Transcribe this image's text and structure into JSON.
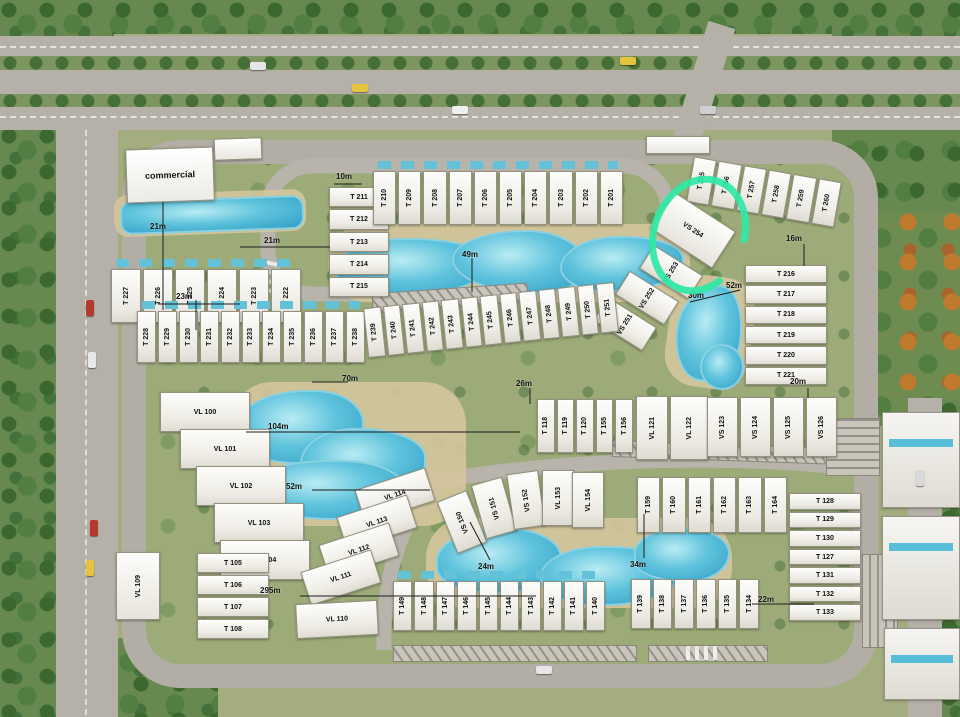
{
  "map": {
    "commercial_label": "commercial",
    "highlight": {
      "unit": "VS 254",
      "color": "#2fe8a5"
    },
    "colors": {
      "road": "#b5b1a8",
      "water": "#4fb6d6",
      "trees": "#4c7a3d",
      "annotation": "#2fe8a5"
    },
    "clusters": {
      "row_a": [
        "T 227",
        "T 226",
        "T 225",
        "T 224",
        "T 223",
        "T 222"
      ],
      "col_b": [
        "T 211",
        "T 212",
        "T 213",
        "T 214",
        "T 215"
      ],
      "row_c": [
        "T 210",
        "T 209",
        "T 208",
        "T 207",
        "T 206",
        "T 205",
        "T 204",
        "T 203",
        "T 202",
        "T 201"
      ],
      "row_d": [
        "T 255",
        "T 256",
        "T 257",
        "T 258",
        "T 259",
        "T 260"
      ],
      "col_e": [
        "T 216",
        "T 217",
        "T 218",
        "T 219",
        "T 220",
        "T 221"
      ],
      "vs_diag": [
        "VS 251",
        "VS 252",
        "VS 253"
      ],
      "vs_circled": "VS 254",
      "row_g": [
        "T 228",
        "T 229",
        "T 230",
        "T 231",
        "T 232",
        "T 233",
        "T 234",
        "T 235",
        "T 236",
        "T 237",
        "T 238"
      ],
      "row_h": [
        "T 239",
        "T 240",
        "T 241",
        "T 242",
        "T 243",
        "T 244",
        "T 245",
        "T 246",
        "T 247",
        "T 248",
        "T 249",
        "T 250",
        "T 251"
      ],
      "col_vl1": [
        "VL 100",
        "VL 101",
        "VL 102",
        "VL 103",
        "VL 104"
      ],
      "col_t105": [
        "T 105",
        "T 106",
        "T 107",
        "T 108"
      ],
      "vl_109": "VL 109",
      "col_vl2": [
        "VL 114",
        "VL 113",
        "VL 112",
        "VL 111",
        "VL 110"
      ],
      "row_m": [
        "T 118",
        "T 119",
        "T 120",
        "T 155",
        "T 156"
      ],
      "vl_pair": [
        "VL 121",
        "VL 122"
      ],
      "vs_row": [
        "VS 123",
        "VS 124",
        "VS 125",
        "VS 126"
      ],
      "vs_mid": [
        "VS 150",
        "VS 151",
        "VS 152",
        "VL 153",
        "VL 154"
      ],
      "row_q": [
        "T 159",
        "T 160",
        "T 161",
        "T 162",
        "T 163",
        "T 164"
      ],
      "row_r": [
        "T 149",
        "T 148",
        "T 147",
        "T 146",
        "T 145",
        "T 144",
        "T 143",
        "T 142",
        "T 141",
        "T 140"
      ],
      "row_s": [
        "T 139",
        "T 138",
        "T 137",
        "T 136",
        "T 135",
        "T 134"
      ],
      "col_t": [
        "T 128",
        "T 129",
        "T 130",
        "T 127",
        "T 131",
        "T 132",
        "T 133"
      ]
    },
    "distances": {
      "d0": "21m",
      "d1": "21m",
      "d2": "23m",
      "d3": "10m",
      "d4": "49m",
      "d5": "16m",
      "d6": "52m",
      "d7": "30m",
      "d8": "26m",
      "d9": "70m",
      "d10": "20m",
      "d11": "104m",
      "d12": "52m",
      "d13": "24m",
      "d14": "34m",
      "d15": "295m",
      "d16": "22m"
    }
  }
}
